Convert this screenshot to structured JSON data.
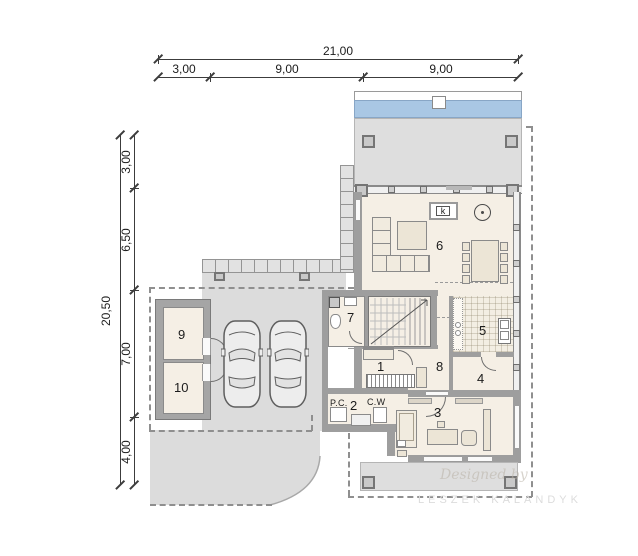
{
  "drawing": {
    "type": "floor-plan"
  },
  "dimensions": {
    "top": {
      "total": "21,00",
      "segments": [
        "3,00",
        "9,00",
        "9,00"
      ]
    },
    "left": {
      "total": "20,50",
      "segments": [
        "3,00",
        "6,50",
        "7,00",
        "4,00"
      ]
    }
  },
  "rooms": [
    {
      "number": "1"
    },
    {
      "number": "2"
    },
    {
      "number": "3"
    },
    {
      "number": "4"
    },
    {
      "number": "5"
    },
    {
      "number": "6"
    },
    {
      "number": "7"
    },
    {
      "number": "8"
    },
    {
      "number": "9"
    },
    {
      "number": "10"
    }
  ],
  "annotations": {
    "fireplace": "k",
    "boiler": "P.C.",
    "water_heater": "C.W"
  },
  "watermarks": {
    "script": "Designed by",
    "studio": "LESZEK KALANDYK"
  },
  "colors": {
    "water_blue": "#a9c7e4",
    "wall_gray": "#9e9e9e",
    "paving_gray": "#dcdcdc",
    "floor_cream": "#f5efe5",
    "line_dark": "#3c3c3c"
  }
}
